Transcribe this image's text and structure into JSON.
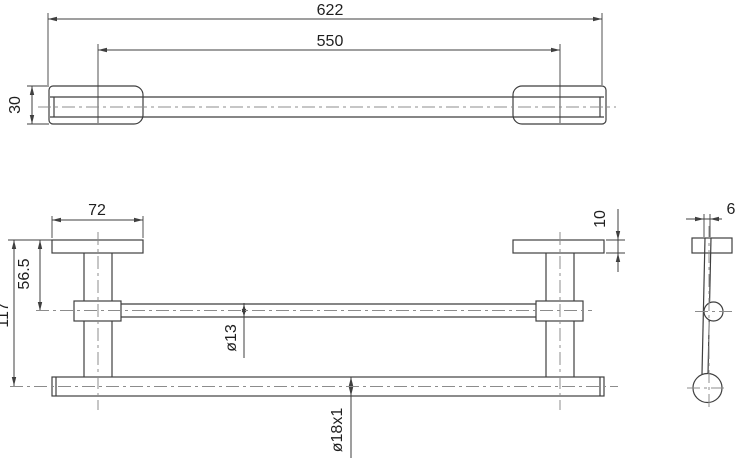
{
  "drawing": {
    "type": "technical-orthographic-drawing",
    "subject": "wall-mounted towel bar",
    "colors": {
      "line": "#3f3f3f",
      "centerline": "#8c8c8c",
      "text": "#1f1f1f",
      "background": "#ffffff"
    },
    "views": {
      "top": {
        "overall_length": "622",
        "mount_spacing": "550",
        "depth": "30"
      },
      "front": {
        "flange_width": "72",
        "flange_thickness": "10",
        "rail_offset": "56.5",
        "overall_height": "117",
        "rail_diameter": "ø13",
        "bar_tube": "ø18x1"
      },
      "side": {
        "arm_thickness": "6"
      }
    }
  }
}
